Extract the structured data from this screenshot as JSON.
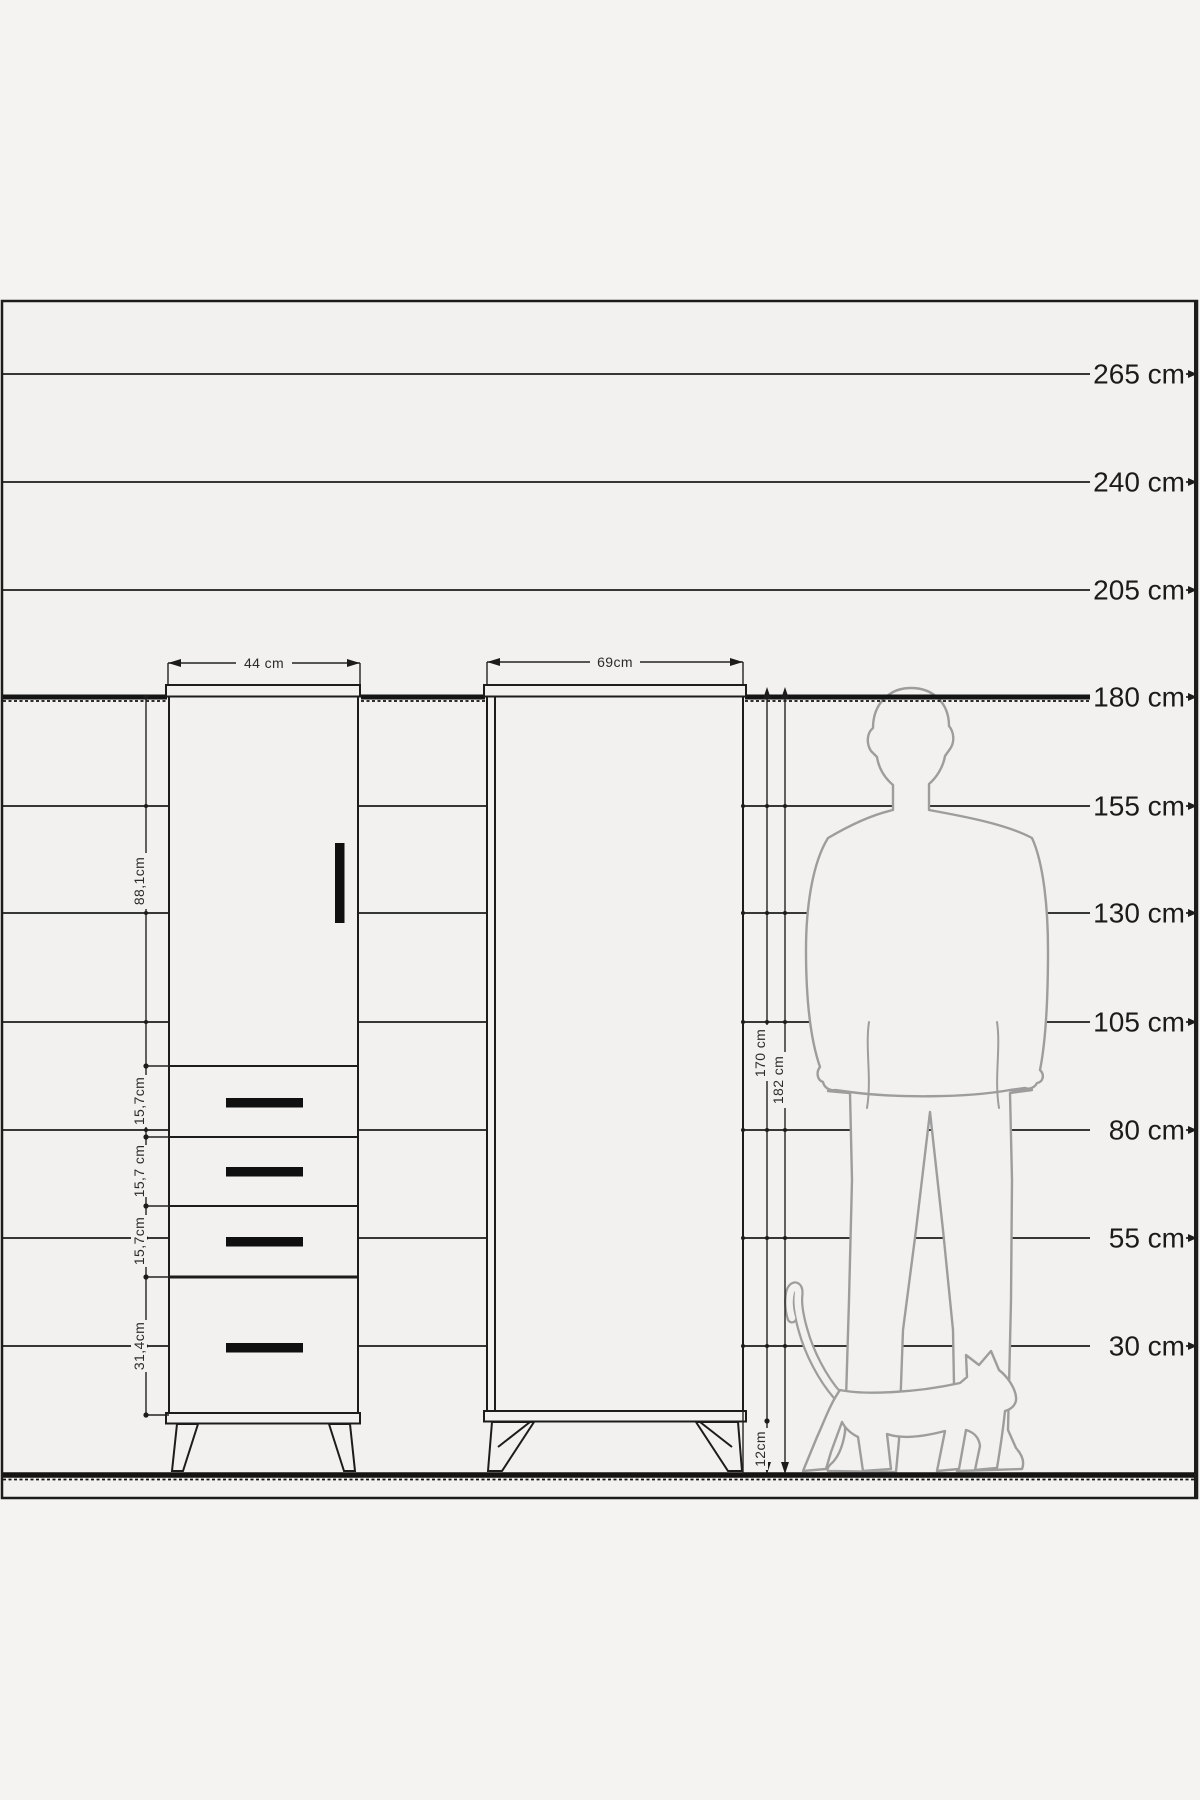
{
  "scale": {
    "unit": "cm",
    "marks": [
      {
        "label": "265 cm"
      },
      {
        "label": "240 cm"
      },
      {
        "label": "205 cm"
      },
      {
        "label": "180 cm"
      },
      {
        "label": "155 cm"
      },
      {
        "label": "130 cm"
      },
      {
        "label": "105 cm"
      },
      {
        "label": "80 cm"
      },
      {
        "label": "55 cm"
      },
      {
        "label": "30 cm"
      }
    ]
  },
  "small_cabinet": {
    "width_label": "44 cm",
    "door_height_label": "88,1cm",
    "drawer_labels": [
      "15,7cm",
      "15,7 cm",
      "15,7cm",
      "31,4cm"
    ]
  },
  "large_cabinet": {
    "width_label": "69cm",
    "body_height_label": "170 cm",
    "total_height_label": "182 cm",
    "leg_height_label": "12cm"
  },
  "colors": {
    "ink": "#1c1c1c",
    "silhouette": "#9d9d9d",
    "paper": "#f2f1ef",
    "paper_outer": "#f4f3f1"
  }
}
